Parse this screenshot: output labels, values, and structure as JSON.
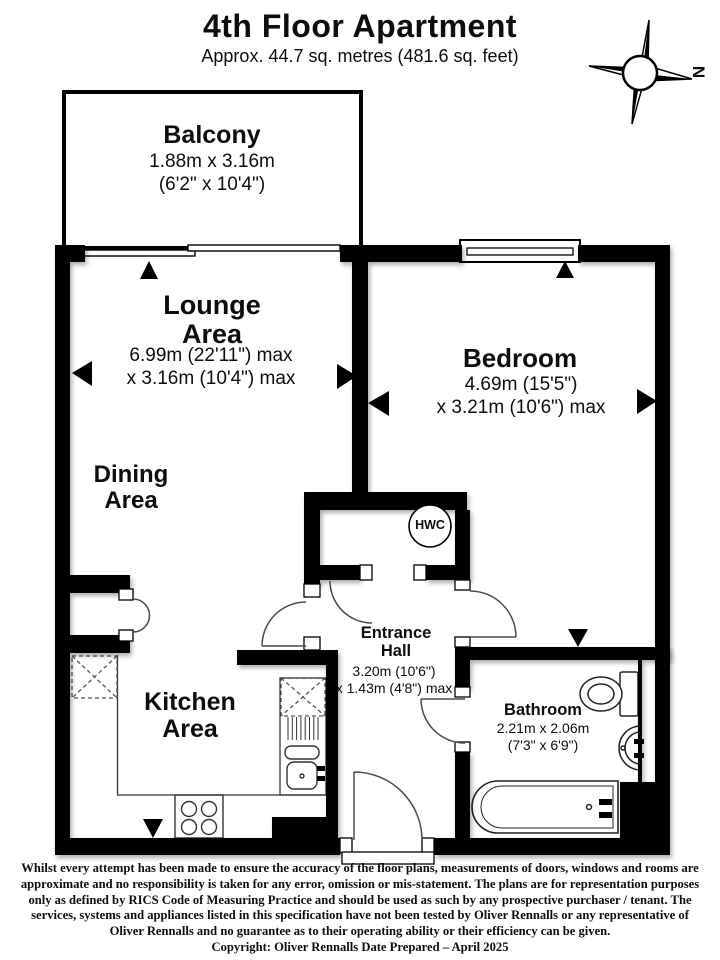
{
  "header": {
    "title": "4th Floor Apartment",
    "subtitle": "Approx. 44.7 sq. metres (481.6 sq. feet)"
  },
  "compass": {
    "north_label": "N"
  },
  "rooms": {
    "balcony": {
      "name": "Balcony",
      "dims": "1.88m x 3.16m\n(6'2\" x 10'4\")"
    },
    "lounge": {
      "name": "Lounge\nArea",
      "dims": "6.99m (22'11\") max\nx 3.16m (10'4\") max"
    },
    "dining": {
      "name": "Dining\nArea"
    },
    "bedroom": {
      "name": "Bedroom",
      "dims": "4.69m (15'5\")\nx 3.21m (10'6\") max"
    },
    "kitchen": {
      "name": "Kitchen\nArea"
    },
    "entrance_hall": {
      "name": "Entrance\nHall",
      "dims": "3.20m (10'6\")\nx 1.43m (4'8\") max"
    },
    "bathroom": {
      "name": "Bathroom",
      "dims": "2.21m x 2.06m\n(7'3\" x 6'9\")"
    },
    "hwc_cupboard": {
      "label": "HWC"
    }
  },
  "footer": {
    "disclaimer_lines": [
      "Whilst every attempt has been made to ensure the accuracy of the floor plans, measurements of doors, windows and rooms are",
      "approximate and no responsibility is taken for any error, omission or mis-statement. The plans are for representation purposes",
      "only as defined by RICS Code of Measuring Practice and should be used as such by any prospective purchaser / tenant. The",
      "services, systems and appliances listed in this specification have not been tested by Oliver Rennalls or any representative of",
      "Oliver Rennalls and no guarantee as to their operating ability or their efficiency can be given."
    ],
    "copyright": "Copyright: Oliver Rennalls Date Prepared – April 2025"
  },
  "colors": {
    "wall": "#000000",
    "line": "#3a3a3a",
    "text": "#0d0d0d"
  }
}
